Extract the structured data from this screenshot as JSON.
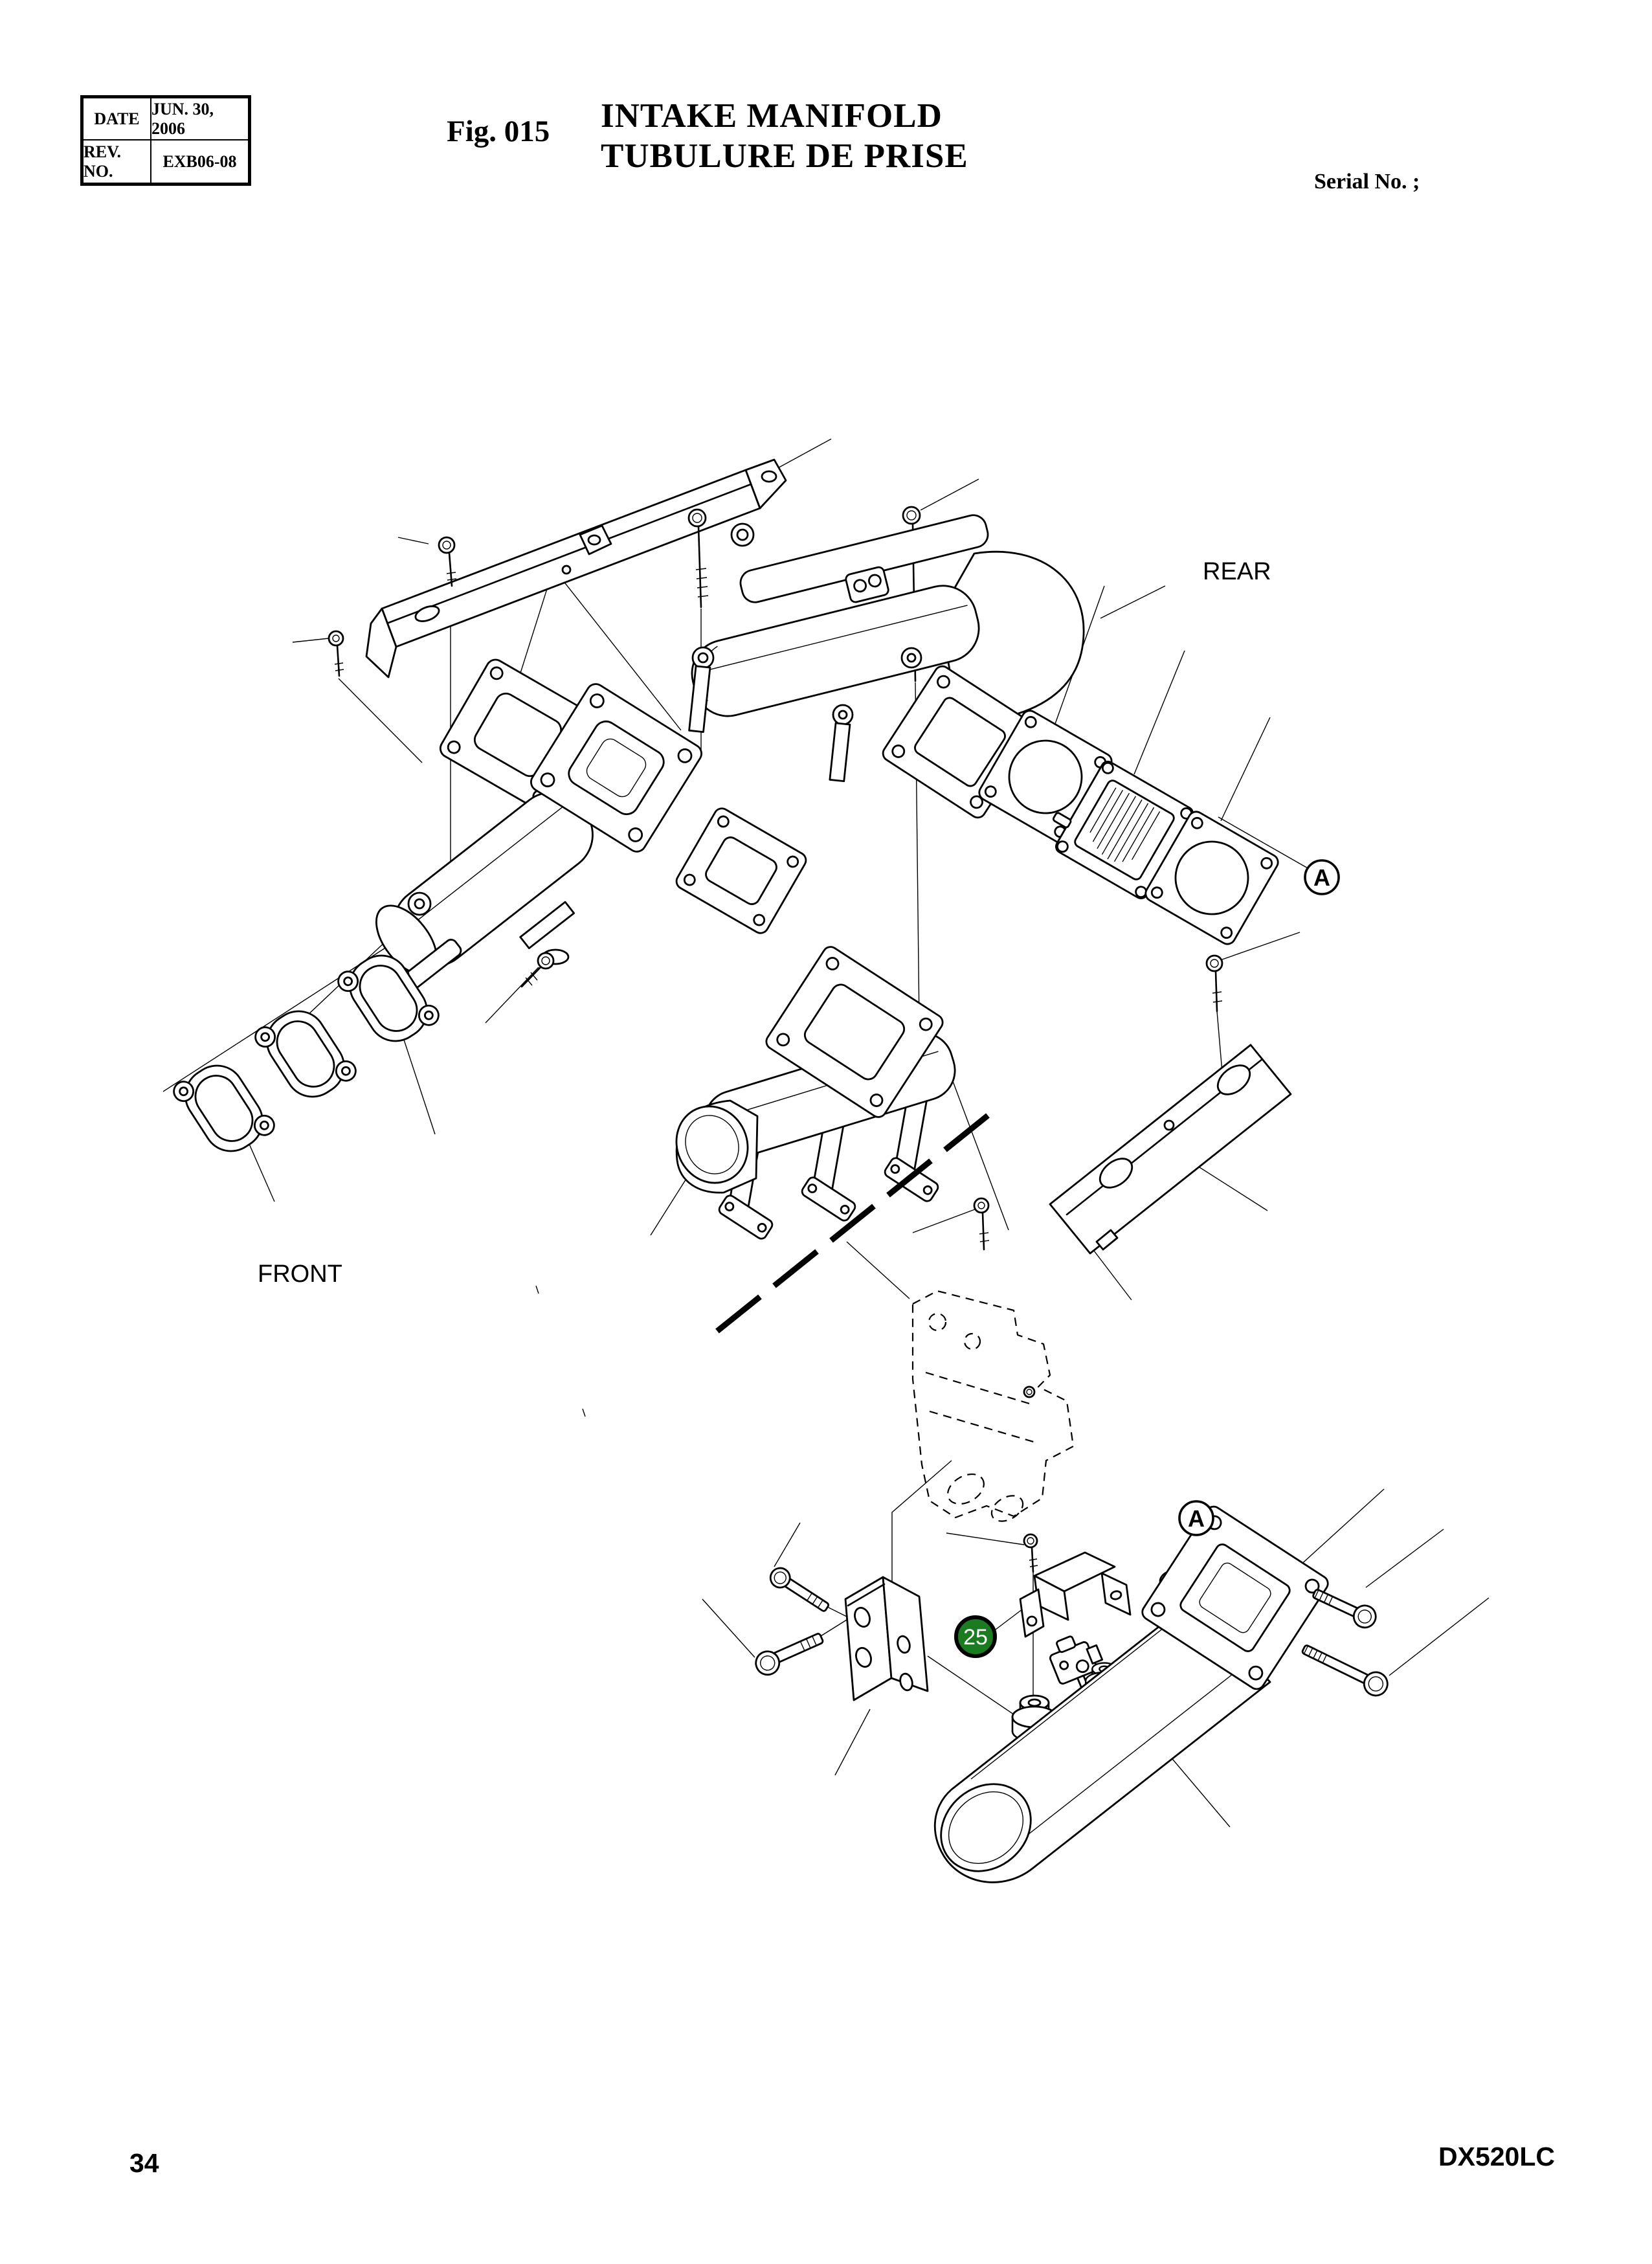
{
  "header": {
    "info_table": {
      "rows": [
        {
          "label": "DATE",
          "value": "JUN. 30, 2006"
        },
        {
          "label": "REV. NO.",
          "value": "EXB06-08"
        }
      ]
    },
    "figure_label": "Fig. 015",
    "title_en": "INTAKE MANIFOLD",
    "title_fr": "TUBULURE DE PRISE",
    "serial_label": "Serial No. ;"
  },
  "diagram": {
    "orientation_labels": {
      "rear": "REAR",
      "front": "FRONT"
    },
    "detail_markers": [
      {
        "label": "A"
      },
      {
        "label": "A"
      }
    ],
    "part_callouts": [
      {
        "number": "25",
        "color": "#1b7b21"
      }
    ]
  },
  "footer": {
    "page_number": "34",
    "model": "DX520LC"
  }
}
